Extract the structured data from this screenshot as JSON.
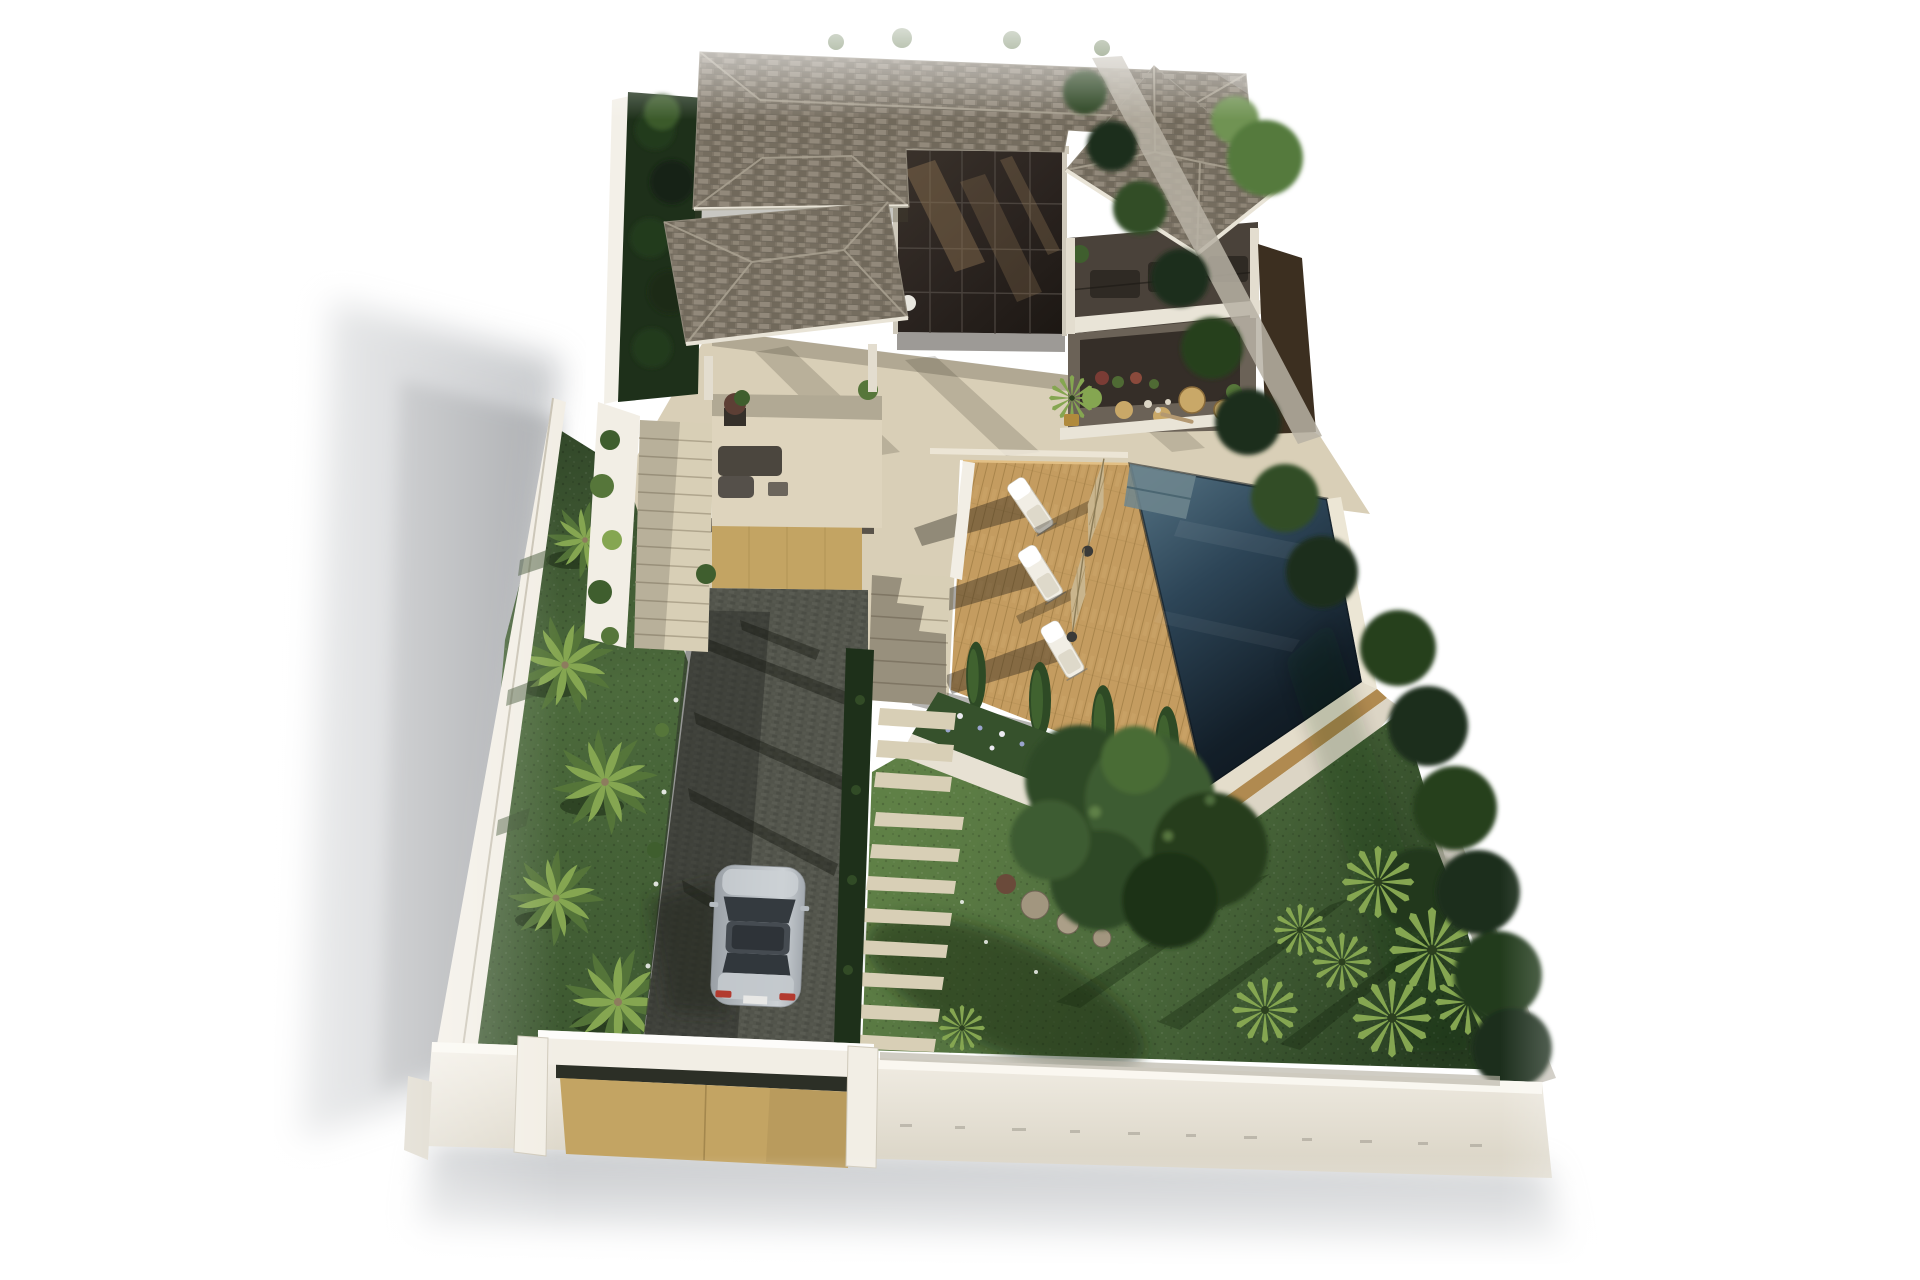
{
  "meta": {
    "title": "Aerial 3D architectural rendering of a two-storey villa with infinity pool, wooden sun deck, palm-lined driveway, walled garden and entrance gate",
    "view": "aerial-isometric",
    "style": "photorealistic-3d-render"
  },
  "palette": {
    "background": "#ffffff",
    "roof": "#7e7567",
    "roof_light": "#aaa292",
    "roof_dark": "#645d50",
    "fascia": "#e9e4d7",
    "glass": "#2b2420",
    "glass_reflection": "#8d7352",
    "wall": "#f2eee5",
    "wall_shade": "#d8d2c3",
    "coping_gray": "#b7b2a5",
    "terrace": "#d9cfb7",
    "terrace_shade": "#bfb49a",
    "deck": "#c49c60",
    "deck_line": "#9e7a42",
    "pool_light": "#547283",
    "pool_mid": "#2d4557",
    "pool_deep": "#131f29",
    "coping": "#ece6d5",
    "lawn": "#4c6a3c",
    "lawn_light": "#5f8046",
    "lawn_dark": "#263c20",
    "hedge": "#1e301a",
    "hedge_light": "#3f5e2e",
    "palm": "#85a651",
    "palm_dark": "#56763a",
    "driveway": "#53554c",
    "driveway_dark": "#33352f",
    "path_stone": "#d8cfb6",
    "flower_white": "#eceaf2",
    "flower_violet": "#9aa4cd",
    "umbrella": "#c9b58d",
    "lounger": "#f1eee5",
    "car_body": "#b6bcc1",
    "car_glass": "#343a3f",
    "taillight": "#b23a2f",
    "gate": "#c3a463",
    "trunk": "#8d7c5e",
    "rock": "#a2967f",
    "bronze": "#3c2f20",
    "cast_shadow": "#90949a"
  },
  "inventory": {
    "sun_loungers": 3,
    "pool_umbrellas": 2,
    "driveway_palm_trees": 5,
    "cypress_trees": 4,
    "garden_fan_palms": 7,
    "cars": 1,
    "swimming_pools": 1,
    "entrance_gates": 1,
    "garage_doors": 1
  },
  "regions": {
    "house": "top",
    "pool_and_deck": "middle-right",
    "driveway": "left",
    "garden": "bottom-right",
    "entrance_gate": "bottom-left"
  }
}
